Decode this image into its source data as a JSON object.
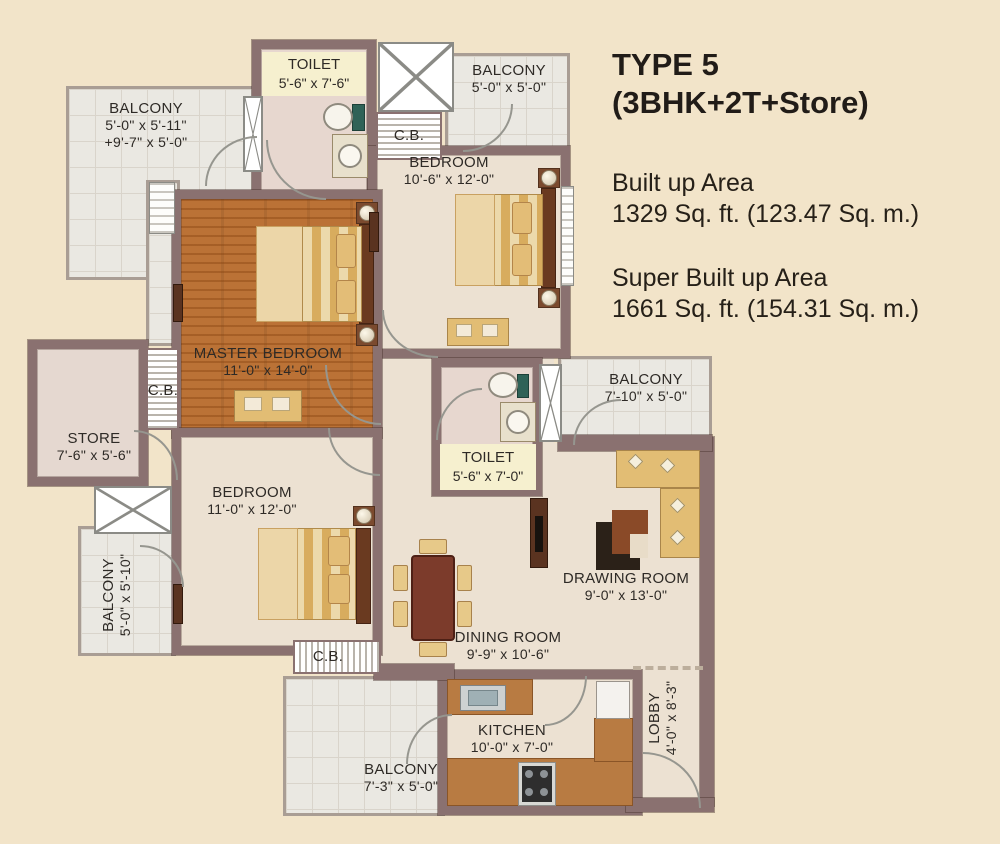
{
  "panel": {
    "title_line1": "TYPE 5",
    "title_line2": "(3BHK+2T+Store)",
    "built_up_label": "Built up Area",
    "built_up_value": "1329 Sq. ft. (123.47 Sq. m.)",
    "super_built_up_label": "Super Built up Area",
    "super_built_up_value": "1661 Sq. ft. (154.31 Sq. m.)"
  },
  "rooms": {
    "balcony_top_left": {
      "name": "BALCONY",
      "dims": "5'-0\" x 5'-11\"",
      "dims2": "+9'-7\" x 5'-0\""
    },
    "toilet_top": {
      "name": "TOILET",
      "dims": "5'-6\" x 7'-6\""
    },
    "cb_top": {
      "name": "C.B."
    },
    "balcony_top_right": {
      "name": "BALCONY",
      "dims": "5'-0\" x 5'-0\""
    },
    "bedroom_top": {
      "name": "BEDROOM",
      "dims": "10'-6\" x 12'-0\""
    },
    "master_bedroom": {
      "name": "MASTER BEDROOM",
      "dims": "11'-0\" x 14'-0\""
    },
    "cb_left": {
      "name": "C.B."
    },
    "store": {
      "name": "STORE",
      "dims": "7'-6\" x 5'-6\""
    },
    "toilet_mid": {
      "name": "TOILET",
      "dims": "5'-6\" x 7'-0\""
    },
    "balcony_right": {
      "name": "BALCONY",
      "dims": "7'-10\" x 5'-0\""
    },
    "bedroom_bottom": {
      "name": "BEDROOM",
      "dims": "11'-0\" x 12'-0\""
    },
    "balcony_left": {
      "name": "BALCONY",
      "dims": "5'-0\" x 5'-10\""
    },
    "drawing_room": {
      "name": "DRAWING ROOM",
      "dims": "9'-0\" x 13'-0\""
    },
    "dining_room": {
      "name": "DINING ROOM",
      "dims": "9'-9\" x 10'-6\""
    },
    "cb_bottom": {
      "name": "C.B."
    },
    "kitchen": {
      "name": "KITCHEN",
      "dims": "10'-0\" x 7'-0\""
    },
    "balcony_bottom": {
      "name": "BALCONY",
      "dims": "7'-3\" x 5'-0\""
    },
    "lobby": {
      "name": "LOBBY",
      "dims": "4'-0\" x 8'-3\""
    }
  },
  "colors": {
    "background": "#f2e4c9",
    "wall": "#8a7170",
    "floor": "#ece1d2",
    "wood": "#c1793c",
    "tile": "#eae8e2",
    "toilet_floor": "#e7d7cf",
    "label_bg": "#f6f0cf",
    "counter": "#b87b42",
    "table": "#7c3b2b",
    "text": "#2e2a26"
  }
}
